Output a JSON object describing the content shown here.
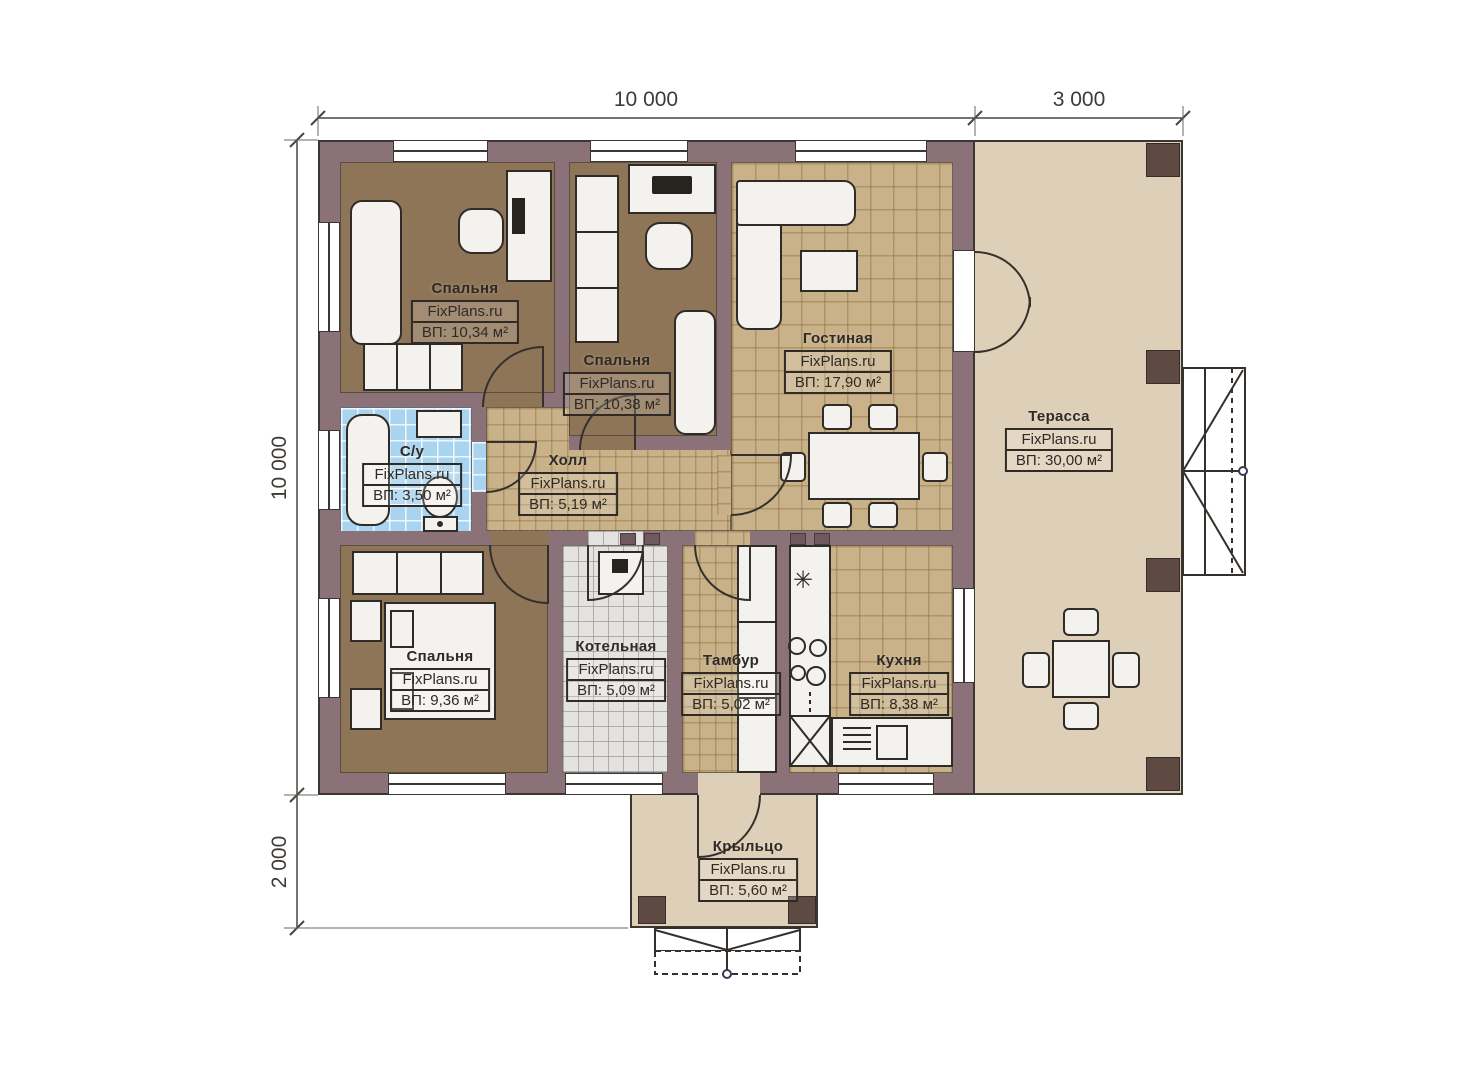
{
  "dimensions": {
    "top_main": "10 000",
    "top_terrace": "3 000",
    "left_main": "10 000",
    "left_porch": "2 000"
  },
  "rooms": [
    {
      "id": "bedroom-top-left",
      "name": "Спальня",
      "watermark": "FixPlans.ru",
      "area": "ВП: 10,34 м²"
    },
    {
      "id": "bedroom-top-middle",
      "name": "Спальня",
      "watermark": "FixPlans.ru",
      "area": "ВП: 10,38 м²"
    },
    {
      "id": "living-room",
      "name": "Гостиная",
      "watermark": "FixPlans.ru",
      "area": "ВП: 17,90 м²"
    },
    {
      "id": "terrace",
      "name": "Терасса",
      "watermark": "FixPlans.ru",
      "area": "ВП: 30,00 м²"
    },
    {
      "id": "bathroom",
      "name": "С/у",
      "watermark": "FixPlans.ru",
      "area": "ВП: 3,50 м²"
    },
    {
      "id": "hall",
      "name": "Холл",
      "watermark": "FixPlans.ru",
      "area": "ВП: 5,19 м²"
    },
    {
      "id": "bedroom-bottom-left",
      "name": "Спальня",
      "watermark": "FixPlans.ru",
      "area": "ВП: 9,36 м²"
    },
    {
      "id": "boiler-room",
      "name": "Котельная",
      "watermark": "FixPlans.ru",
      "area": "ВП: 5,09 м²"
    },
    {
      "id": "vestibule",
      "name": "Тамбур",
      "watermark": "FixPlans.ru",
      "area": "ВП: 5,02 м²"
    },
    {
      "id": "kitchen",
      "name": "Кухня",
      "watermark": "FixPlans.ru",
      "area": "ВП: 8,38 м²"
    },
    {
      "id": "porch",
      "name": "Крыльцо",
      "watermark": "FixPlans.ru",
      "area": "ВП: 5,60 м²"
    }
  ],
  "icons": {
    "freezer_star": "✳"
  },
  "colors": {
    "wall": "#8b7278",
    "outline": "#3c3733",
    "bedroom_floor": "#8e7557",
    "tile_floor": "#c9b189",
    "terrace_floor": "#decfb9",
    "bathroom_floor": "#a9d4ef",
    "boiler_floor": "#e4e3e1",
    "post": "#5e4a42",
    "furniture": "#f3f2ef"
  }
}
